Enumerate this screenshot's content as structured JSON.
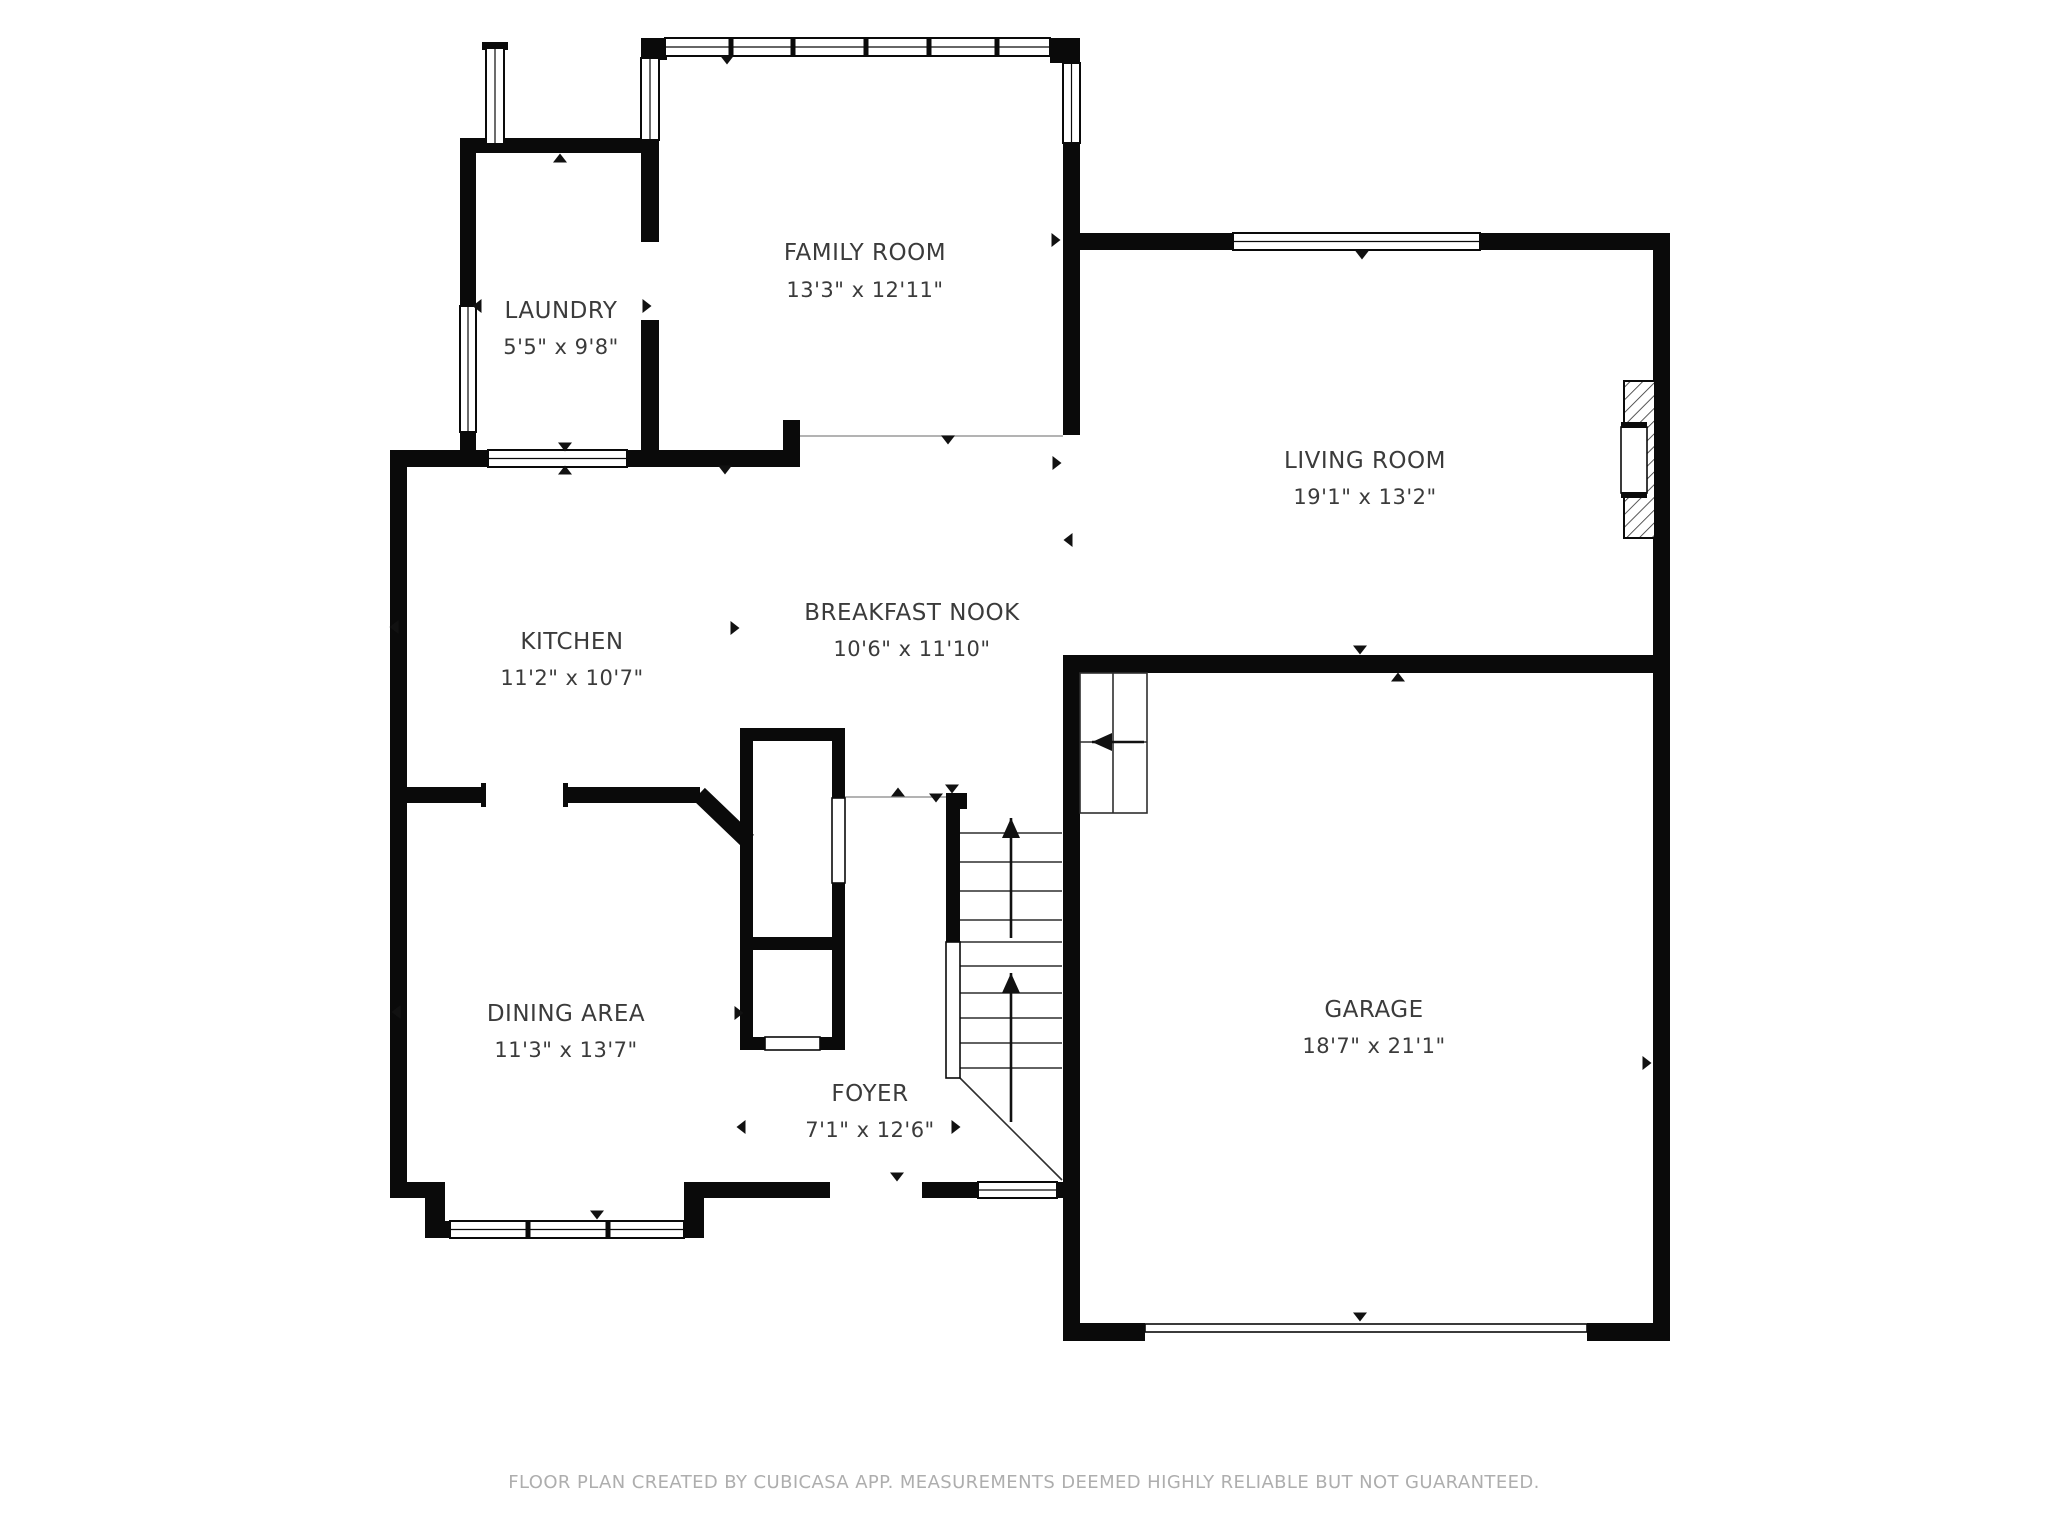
{
  "colors": {
    "wall": "#0a0a0a",
    "thin_line": "#9a9a9a",
    "detail_line": "#2e2e2e",
    "text": "#3b3b3b",
    "footer": "#aeaeae"
  },
  "footer": {
    "text": "FLOOR PLAN CREATED BY CUBICASA APP. MEASUREMENTS DEEMED HIGHLY RELIABLE BUT NOT GUARANTEED."
  },
  "rooms": [
    {
      "id": "family-room",
      "name": "FAMILY ROOM",
      "dims": "13'3\" x 12'11\"",
      "x": 865,
      "name_y": 260,
      "dim_y": 297
    },
    {
      "id": "laundry",
      "name": "LAUNDRY",
      "dims": "5'5\" x 9'8\"",
      "x": 561,
      "name_y": 318,
      "dim_y": 354
    },
    {
      "id": "living-room",
      "name": "LIVING ROOM",
      "dims": "19'1\" x 13'2\"",
      "x": 1365,
      "name_y": 468,
      "dim_y": 504
    },
    {
      "id": "kitchen",
      "name": "KITCHEN",
      "dims": "11'2\" x 10'7\"",
      "x": 572,
      "name_y": 649,
      "dim_y": 685
    },
    {
      "id": "breakfast-nook",
      "name": "BREAKFAST NOOK",
      "dims": "10'6\" x 11'10\"",
      "x": 912,
      "name_y": 620,
      "dim_y": 656
    },
    {
      "id": "dining-area",
      "name": "DINING AREA",
      "dims": "11'3\" x 13'7\"",
      "x": 566,
      "name_y": 1021,
      "dim_y": 1057
    },
    {
      "id": "foyer",
      "name": "FOYER",
      "dims": "7'1\" x 12'6\"",
      "x": 870,
      "name_y": 1101,
      "dim_y": 1137
    },
    {
      "id": "garage",
      "name": "GARAGE",
      "dims": "18'7\" x 21'1\"",
      "x": 1374,
      "name_y": 1017,
      "dim_y": 1053
    }
  ],
  "geometry": {
    "canvas": {
      "width": 2048,
      "height": 1536
    },
    "walls": [
      [
        460,
        138,
        199,
        15
      ],
      [
        460,
        138,
        16,
        168
      ],
      [
        460,
        432,
        16,
        35
      ],
      [
        390,
        450,
        98,
        17
      ],
      [
        627,
        450,
        173,
        17
      ],
      [
        641,
        38,
        26,
        22
      ],
      [
        1050,
        38,
        30,
        25
      ],
      [
        641,
        140,
        18,
        102
      ],
      [
        641,
        320,
        18,
        147
      ],
      [
        1063,
        143,
        17,
        292
      ],
      [
        783,
        420,
        17,
        47
      ],
      [
        390,
        450,
        17,
        748
      ],
      [
        390,
        787,
        93,
        16
      ],
      [
        567,
        787,
        133,
        16
      ],
      [
        740,
        728,
        13,
        322
      ],
      [
        740,
        728,
        105,
        13
      ],
      [
        832,
        728,
        13,
        70
      ],
      [
        832,
        883,
        13,
        167
      ],
      [
        740,
        937,
        105,
        13
      ],
      [
        740,
        1037,
        25,
        13
      ],
      [
        820,
        1037,
        25,
        13
      ],
      [
        390,
        1182,
        35,
        16
      ],
      [
        425,
        1182,
        20,
        56
      ],
      [
        442,
        1221,
        8,
        17
      ],
      [
        684,
        1221,
        8,
        17
      ],
      [
        684,
        1182,
        20,
        56
      ],
      [
        700,
        1182,
        130,
        16
      ],
      [
        922,
        1182,
        56,
        16
      ],
      [
        1057,
        1182,
        23,
        16
      ],
      [
        946,
        793,
        21,
        16
      ],
      [
        946,
        793,
        14,
        149
      ],
      [
        1063,
        655,
        17,
        686
      ],
      [
        1063,
        655,
        607,
        18
      ],
      [
        1653,
        233,
        17,
        1108
      ],
      [
        1063,
        1323,
        82,
        18
      ],
      [
        1587,
        1323,
        83,
        18
      ],
      [
        1080,
        233,
        153,
        17
      ],
      [
        1480,
        233,
        173,
        17
      ],
      [
        481,
        783,
        5,
        24
      ],
      [
        563,
        783,
        5,
        24
      ],
      [
        482,
        42,
        26,
        8
      ]
    ],
    "diagonal_walls": [
      {
        "x1": 699,
        "y1": 794,
        "x2": 748,
        "y2": 841,
        "w": 17
      }
    ],
    "windows": [
      {
        "x": 665,
        "y": 38,
        "w": 385,
        "h": 18,
        "o": "h",
        "m": [
          731,
          793,
          866,
          929,
          997
        ]
      },
      {
        "x": 1233,
        "y": 233,
        "w": 247,
        "h": 17,
        "o": "h",
        "m": []
      },
      {
        "x": 488,
        "y": 450,
        "w": 139,
        "h": 17,
        "o": "h",
        "m": []
      },
      {
        "x": 450,
        "y": 1221,
        "w": 234,
        "h": 17,
        "o": "h",
        "m": [
          528,
          608
        ]
      },
      {
        "x": 978,
        "y": 1182,
        "w": 79,
        "h": 16,
        "o": "h",
        "m": []
      },
      {
        "x": 460,
        "y": 306,
        "w": 16,
        "h": 126,
        "o": "v",
        "m": []
      },
      {
        "x": 641,
        "y": 58,
        "w": 18,
        "h": 82,
        "o": "v",
        "m": []
      },
      {
        "x": 1063,
        "y": 63,
        "w": 17,
        "h": 80,
        "o": "v",
        "m": []
      },
      {
        "x": 486,
        "y": 48,
        "w": 18,
        "h": 96,
        "o": "v",
        "m": []
      }
    ],
    "panels": [
      {
        "x": 946,
        "y": 942,
        "w": 14,
        "h": 136
      },
      {
        "x": 832,
        "y": 798,
        "w": 13,
        "h": 85
      },
      {
        "x": 765,
        "y": 1037,
        "w": 55,
        "h": 13
      },
      {
        "x": 1145,
        "y": 1324,
        "w": 442,
        "h": 8
      }
    ],
    "thin_lines": [
      [
        800,
        436,
        1063,
        436
      ],
      [
        845,
        797,
        946,
        797
      ]
    ],
    "stair_treads": {
      "x1": 960,
      "x2": 1062,
      "ys": [
        833,
        862,
        891,
        920,
        942,
        966,
        993,
        1018,
        1043,
        1068
      ]
    },
    "diagonal_lines": [
      [
        960,
        1078,
        1062,
        1180
      ]
    ],
    "basement_stairs": {
      "x": 1080,
      "y": 673,
      "w": 67,
      "h": 140,
      "divider_x": 1113,
      "row_ys": [
        742
      ],
      "arrow": {
        "x1": 1144,
        "y1": 742,
        "x2": 1092,
        "y2": 742
      }
    },
    "arrows": [
      {
        "x1": 1011,
        "y1": 938,
        "x2": 1011,
        "y2": 818
      },
      {
        "x1": 1011,
        "y1": 1122,
        "x2": 1011,
        "y2": 973
      }
    ],
    "markers": [
      [
        727,
        60,
        "down"
      ],
      [
        560,
        158,
        "up"
      ],
      [
        477,
        306,
        "left"
      ],
      [
        647,
        306,
        "right"
      ],
      [
        565,
        447,
        "down"
      ],
      [
        565,
        470,
        "up"
      ],
      [
        948,
        440,
        "down"
      ],
      [
        1056,
        240,
        "right"
      ],
      [
        1362,
        255,
        "down"
      ],
      [
        1057,
        463,
        "right"
      ],
      [
        1068,
        540,
        "left"
      ],
      [
        735,
        628,
        "right"
      ],
      [
        394,
        627,
        "left"
      ],
      [
        725,
        470,
        "down"
      ],
      [
        898,
        792,
        "up"
      ],
      [
        936,
        798,
        "down"
      ],
      [
        952,
        789,
        "down"
      ],
      [
        739,
        1013,
        "right"
      ],
      [
        396,
        1012,
        "left"
      ],
      [
        597,
        1215,
        "down"
      ],
      [
        897,
        1177,
        "down"
      ],
      [
        741,
        1127,
        "left"
      ],
      [
        956,
        1127,
        "right"
      ],
      [
        1360,
        650,
        "down"
      ],
      [
        1398,
        677,
        "up"
      ],
      [
        1360,
        1317,
        "down"
      ],
      [
        1647,
        1063,
        "right"
      ]
    ],
    "fireplace": {
      "outer": {
        "x": 1624,
        "y": 381,
        "w": 31,
        "h": 157
      },
      "inner": {
        "x": 1621,
        "y": 427,
        "w": 26,
        "h": 66
      },
      "bands": [
        {
          "x": 1621,
          "y": 422,
          "w": 26,
          "h": 6
        },
        {
          "x": 1621,
          "y": 492,
          "w": 26,
          "h": 6
        }
      ]
    }
  }
}
